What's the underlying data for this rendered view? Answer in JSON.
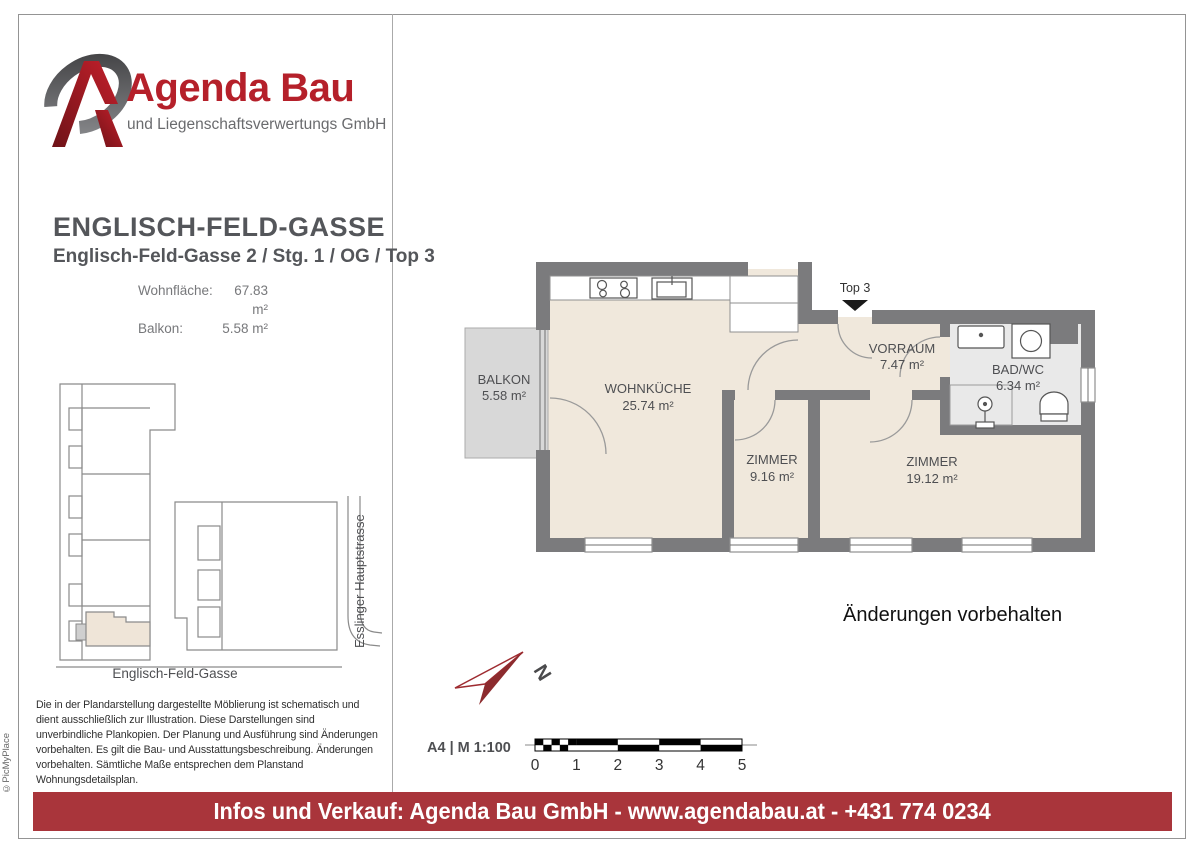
{
  "copyright": "©PicMyPlace",
  "logo": {
    "brand": "Agenda Bau",
    "subtitle": "und Liegenschaftsverwertungs GmbH"
  },
  "header": {
    "title": "ENGLISCH-FELD-GASSE",
    "subtitle": "Englisch-Feld-Gasse 2 / Stg. 1 / OG / Top 3",
    "areas": [
      {
        "label": "Wohnfläche:",
        "value": "67.83 m²"
      },
      {
        "label": "Balkon:",
        "value": "5.58 m²"
      }
    ]
  },
  "site_plan": {
    "street_bottom": "Englisch-Feld-Gasse",
    "street_right": "Esslinger Hauptstrasse"
  },
  "floor_plan": {
    "unit_marker": "Top 3",
    "note": "Änderungen vorbehalten",
    "rooms": [
      {
        "name": "BALKON",
        "area": "5.58 m²"
      },
      {
        "name": "WOHNKÜCHE",
        "area": "25.74 m²"
      },
      {
        "name": "VORRAUM",
        "area": "7.47 m²"
      },
      {
        "name": "BAD/WC",
        "area": "6.34 m²"
      },
      {
        "name": "ZIMMER",
        "area": "9.16 m²"
      },
      {
        "name": "ZIMMER",
        "area": "19.12 m²"
      }
    ]
  },
  "north_label": "N",
  "scale": {
    "format": "A4 | M 1:100",
    "ticks": [
      "0",
      "1",
      "2",
      "3",
      "4",
      "5"
    ]
  },
  "disclaimer": "Die in der Plandarstellung dargestellte Möblierung ist schematisch und dient ausschließlich zur Illustration. Diese Darstellungen sind unverbindliche Plankopien. Der Planung und Ausführung sind Änderungen vorbehalten. Es gilt die Bau- und Ausstattungsbeschreibung. Änderungen vorbehalten. Sämtliche Maße entsprechen dem Planstand Wohnungsdetailsplan.",
  "footer": {
    "text": "Infos und Verkauf: Agenda Bau GmbH - www.agendabau.at - +431 774 0234"
  },
  "colors": {
    "banner": "#A9353B",
    "logo_red": "#B5202A",
    "wall": "#7B7B7D",
    "room_beige": "#F0E8DC",
    "balcony_gray": "#D8D8D8",
    "bath_gray": "#E9E9E9"
  }
}
